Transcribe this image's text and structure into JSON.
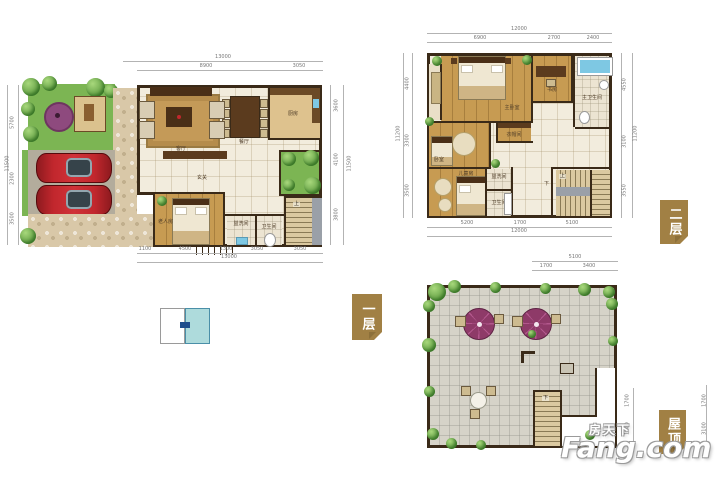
{
  "floor1": {
    "badge": "一层",
    "labels": {
      "living": "客厅",
      "dining": "餐厅",
      "kitchen": "厨房",
      "foyer": "玄关",
      "elder_room": "老人房",
      "washroom": "盥洗间",
      "toilet": "卫生间",
      "stairs_up": "上"
    },
    "dims": {
      "top_total": "13000",
      "top_segs": [
        "8900",
        "3050"
      ],
      "bottom_segs": [
        "1100",
        "4500",
        "1300",
        "3050",
        "3050"
      ],
      "bottom_total": "13000",
      "left_segs": [
        "5700",
        "2300",
        "3500"
      ],
      "left_total": "11500",
      "right_segs": [
        "3600",
        "4100",
        "3800"
      ],
      "right_total": "11500"
    }
  },
  "floor2": {
    "badge": "二层",
    "labels": {
      "master": "主卧室",
      "study": "书房",
      "master_bath": "主卫生间",
      "closet": "衣帽间",
      "bedroom": "卧室",
      "kids": "儿童房",
      "washroom": "盥洗间",
      "toilet": "卫生间",
      "stairs_up": "上",
      "stairs_down": "下"
    },
    "dims": {
      "top_total": "12000",
      "top_segs": [
        "6900",
        "2700",
        "2400"
      ],
      "bottom_segs": [
        "5200",
        "1700",
        "5100"
      ],
      "bottom_total": "12000",
      "left_segs": [
        "4400",
        "3300",
        "3500"
      ],
      "left_total": "11200",
      "right_segs": [
        "4550",
        "3100",
        "3550"
      ],
      "right_total": "11200"
    }
  },
  "roof": {
    "badge": "屋顶",
    "labels": {
      "stairs_down": "下"
    },
    "dims": {
      "top_total": "5100",
      "top_segs": [
        "1700",
        "3400"
      ],
      "right_inner_segs": [
        "1700",
        "1500"
      ],
      "right_outer_segs": [
        "1700",
        "3100"
      ]
    }
  },
  "watermark": {
    "cn": "房天下",
    "en": "Fang.com"
  },
  "colors": {
    "badge_gold": "#a18044",
    "key_plan_teal": "#aedbdc",
    "key_plan_navy": "#1f4e8c",
    "car_red": "#c1272d",
    "umbrella_purple": "#8e3a68",
    "bathtub_blue": "#7ec8e3",
    "garden_green": "#7cb553"
  }
}
